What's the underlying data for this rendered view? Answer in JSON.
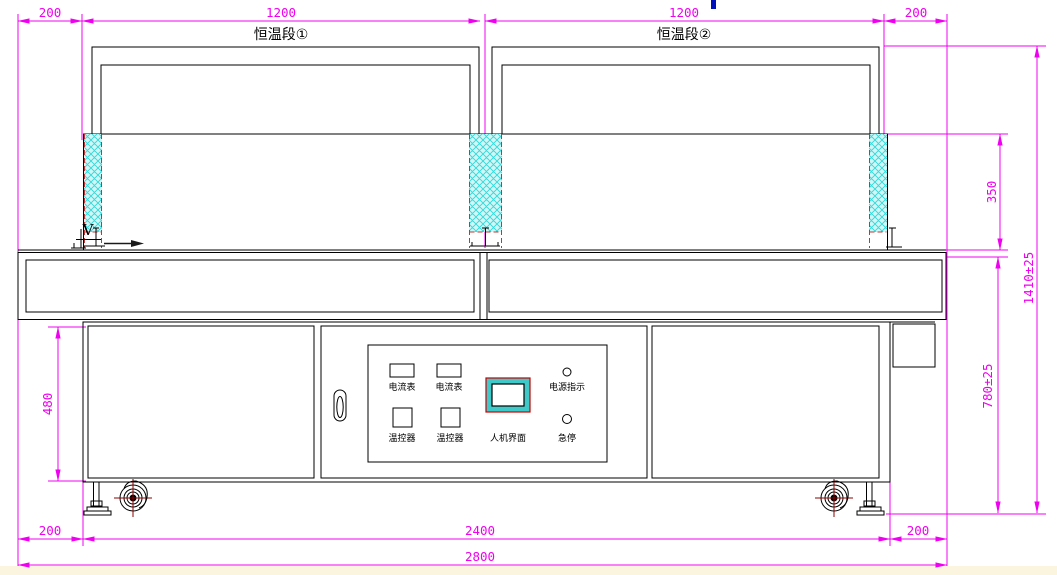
{
  "drawing": {
    "type": "engineering-front-view-tunnel-oven",
    "view_label": "V",
    "sections": [
      {
        "label": "恒温段①"
      },
      {
        "label": "恒温段②"
      }
    ],
    "dimensions": {
      "top": [
        "200",
        "1200",
        "1200",
        "200"
      ],
      "right": [
        "350",
        "1410±25",
        "780±25"
      ],
      "left": [
        "480"
      ],
      "bottom": [
        "200",
        "2400",
        "200",
        "2800"
      ]
    },
    "control_panel": {
      "ammeter_1": "电流表",
      "ammeter_2": "电流表",
      "temp_controller_1": "温控器",
      "temp_controller_2": "温控器",
      "hmi": "人机界面",
      "power_indicator": "电源指示",
      "emergency_stop": "急停"
    },
    "colors": {
      "dimension_magenta": "#f000f0",
      "outline_black": "#000000",
      "insulation_fill": "#d2f6f6",
      "insulation_hatch": "#2fd8d8",
      "hidden_line_red": "#bb3838",
      "caster_centerline": "#8e0000",
      "hmi_frame_cyan": "#3fc9c9",
      "hmi_border_red": "#cc0000",
      "cursor_artifact_blue": "#0011bb",
      "footer_strip": "#fbf5e0"
    }
  }
}
